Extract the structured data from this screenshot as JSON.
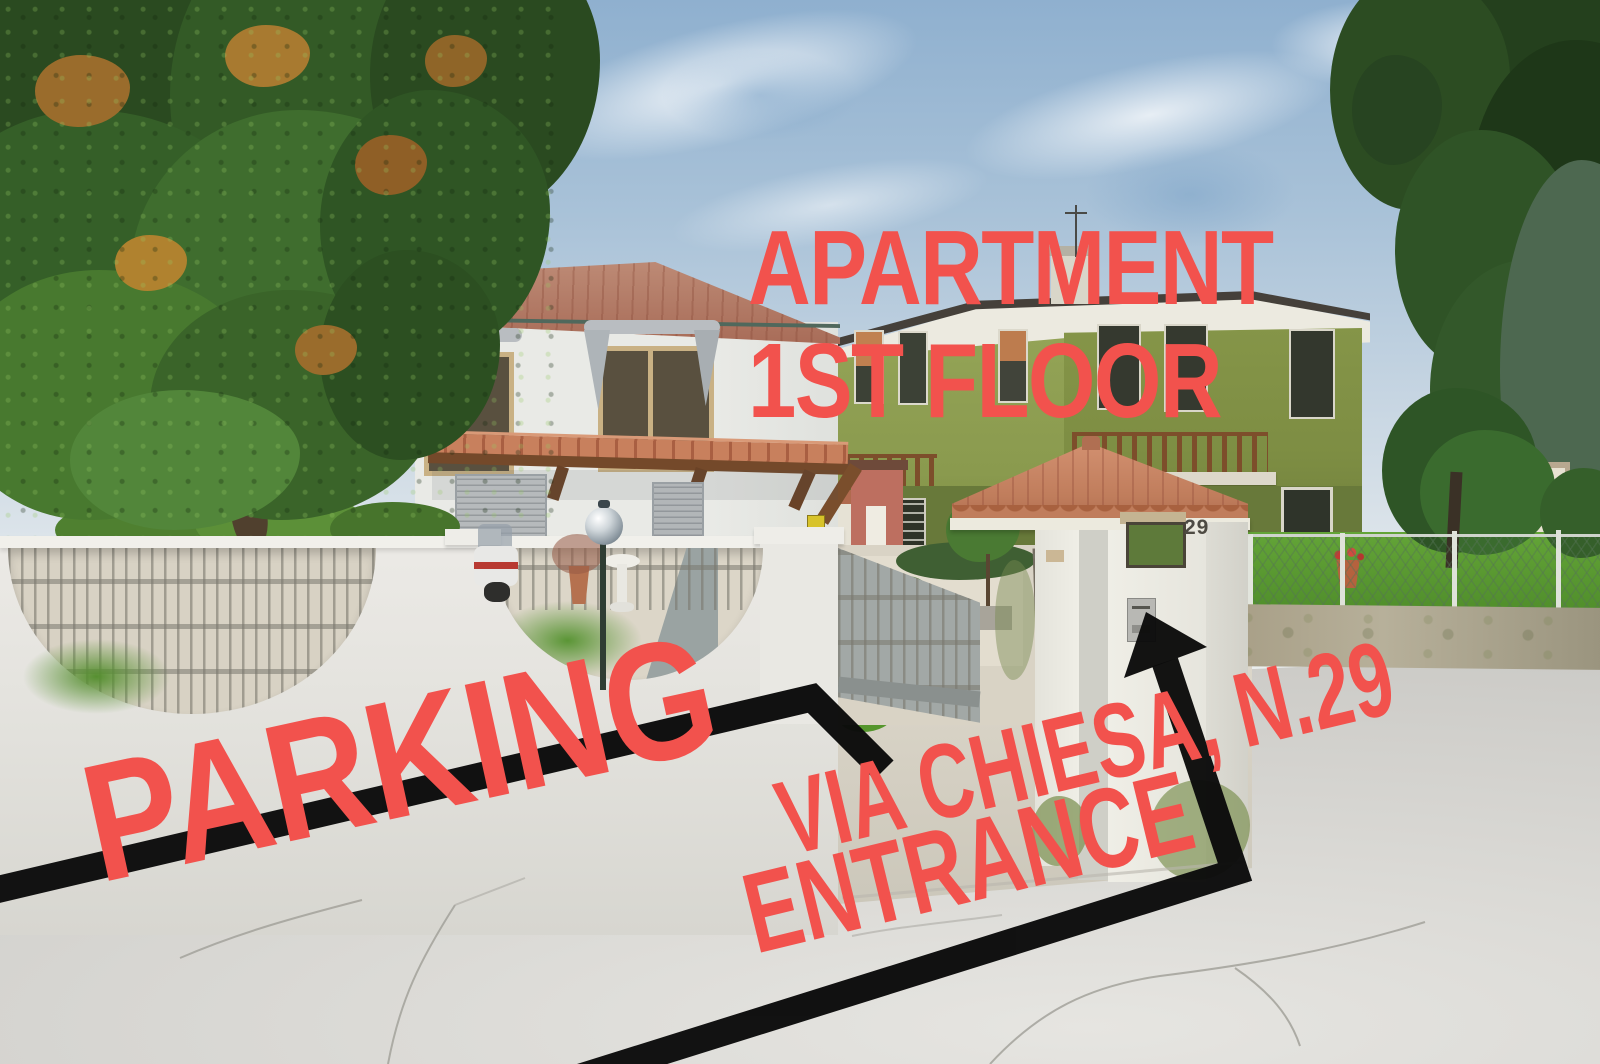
{
  "annotations": {
    "apartment": {
      "line1": "APARTMENT",
      "line2": "1ST FLOOR"
    },
    "parking": "PARKING",
    "street": "VIA CHIESA, N.29",
    "entrance": "ENTRANCE"
  },
  "scene": {
    "house_number": "29"
  },
  "colors": {
    "annotation-red": "#f2524d",
    "arrow-black": "#0b0b0b",
    "sky-top": "#8fb0cf",
    "foliage-dark": "#2a4a20",
    "green-house-wall": "#8c9c51",
    "terracotta-roof": "#c27f5e",
    "road-gray": "#d6d5d1",
    "wall-white": "#eceae6",
    "grass-green": "#5d9a33"
  }
}
